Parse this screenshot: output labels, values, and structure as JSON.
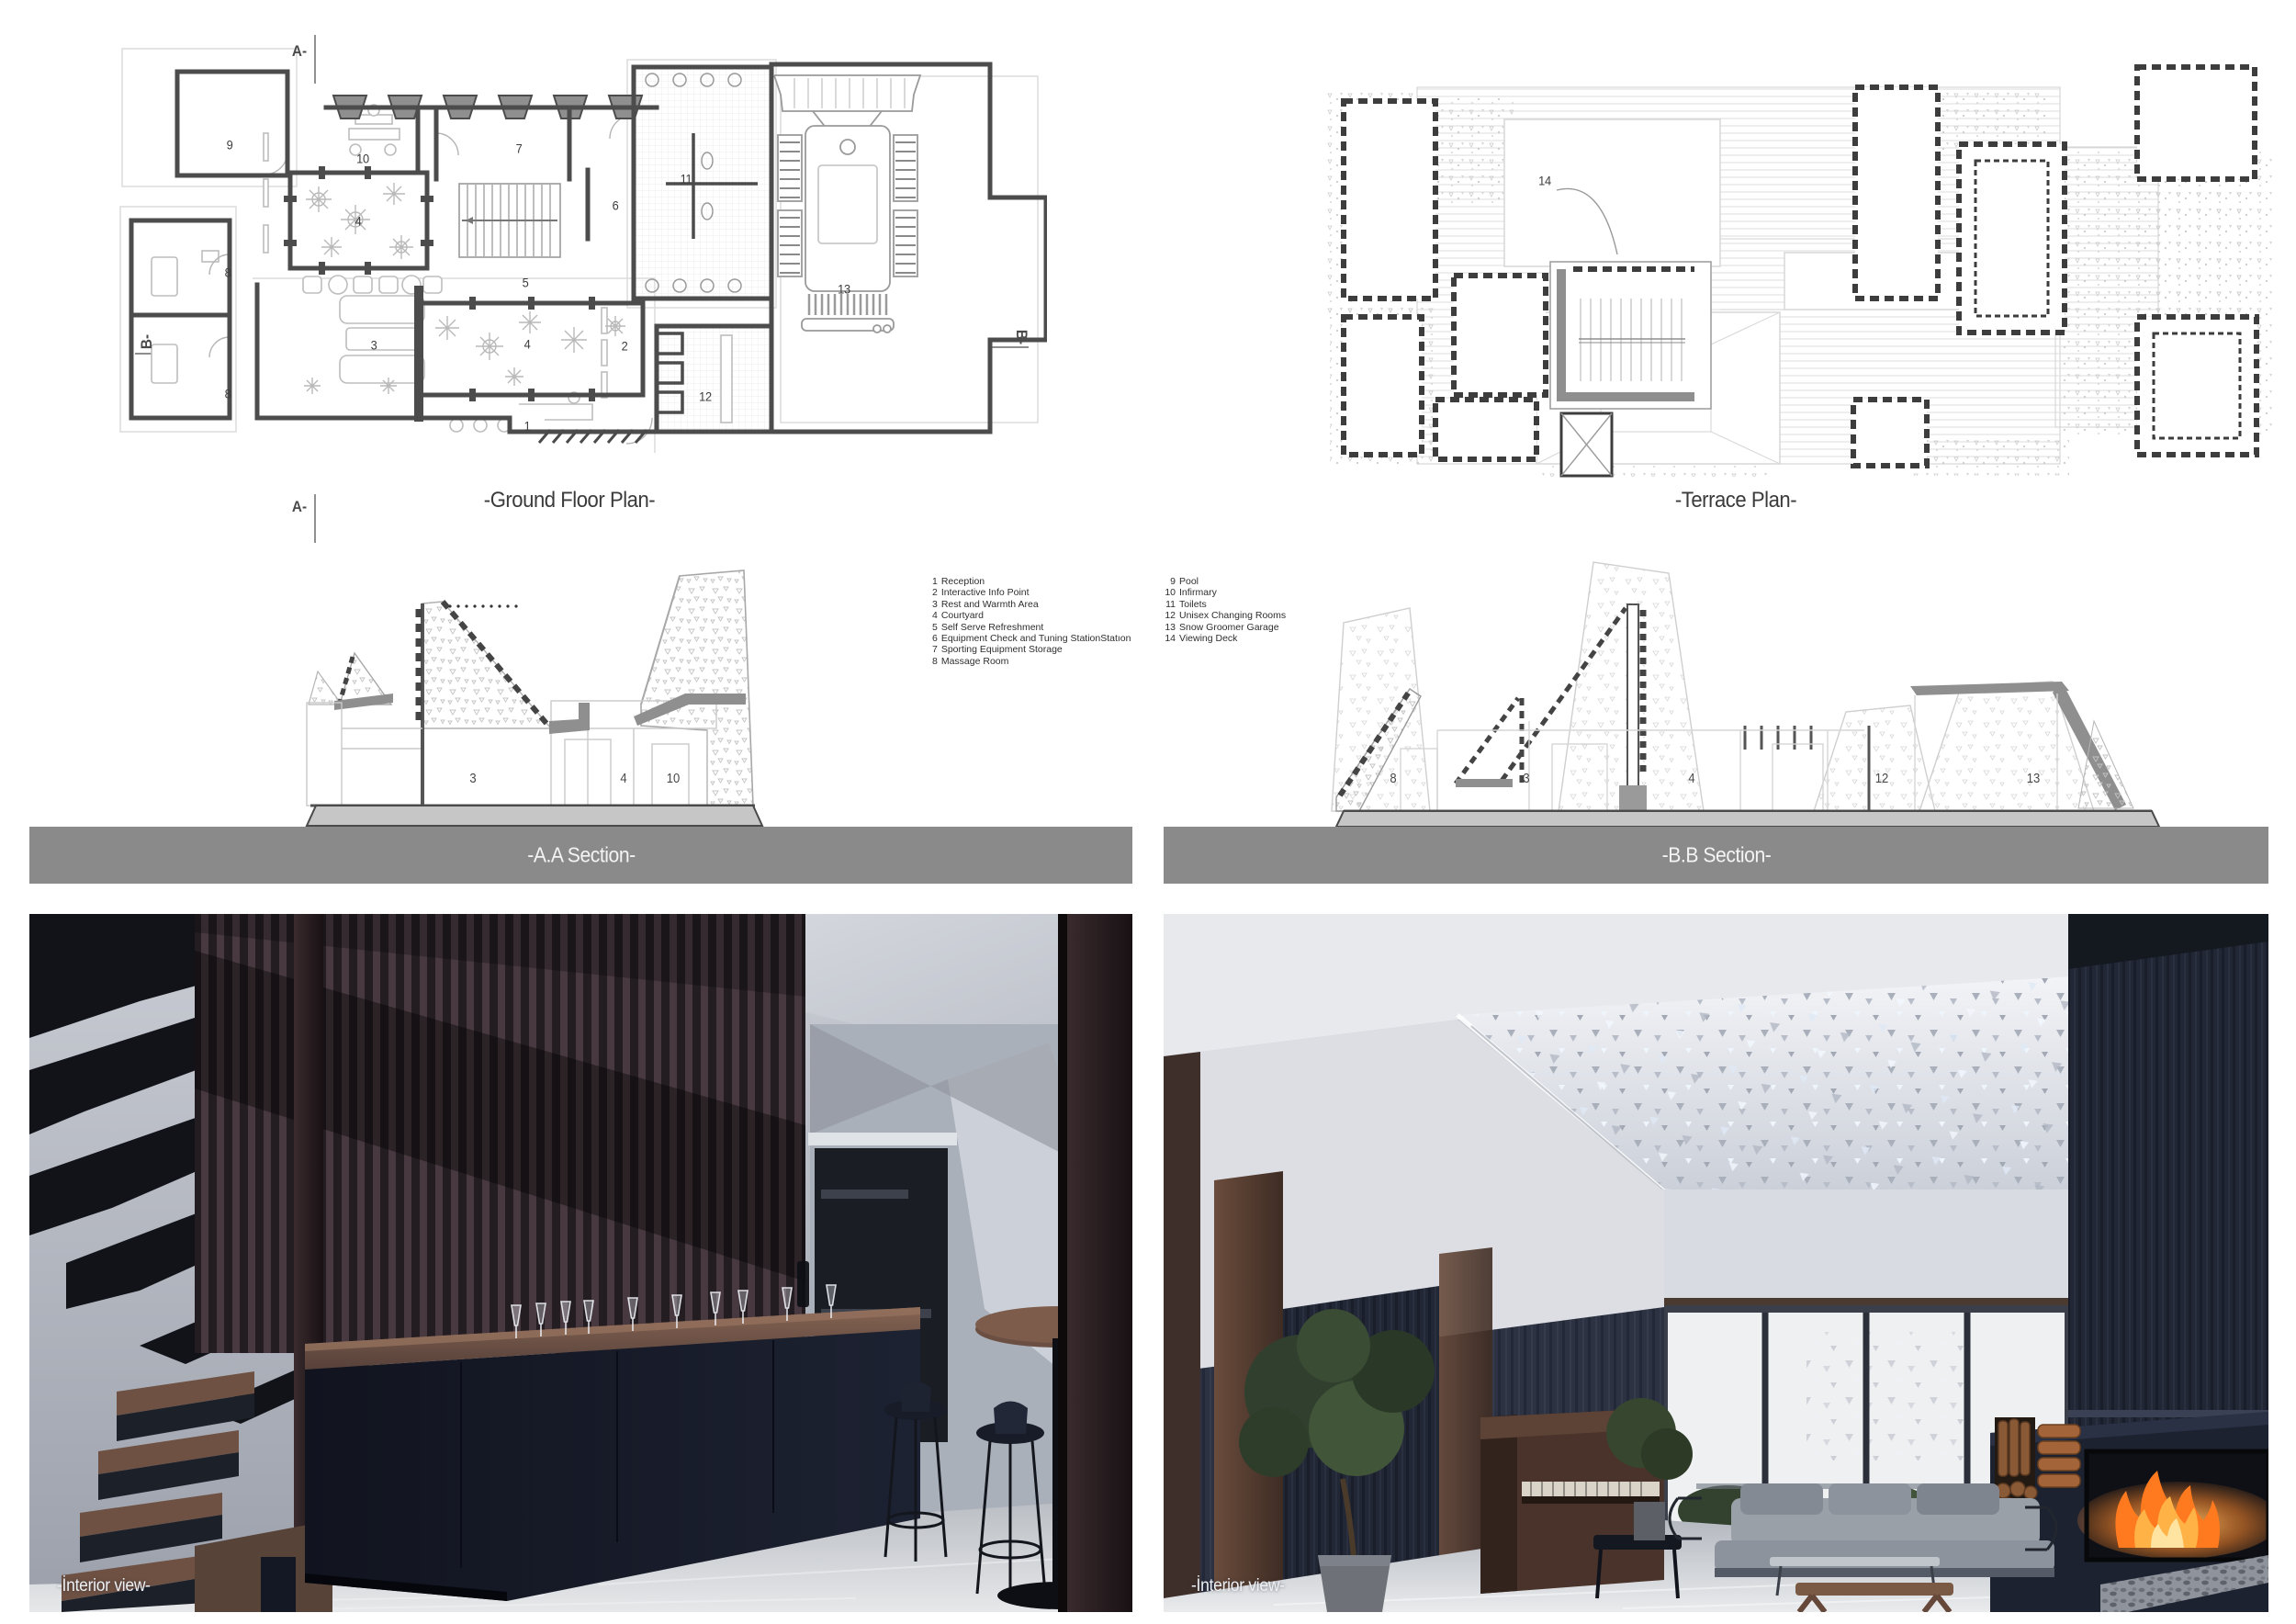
{
  "ground_floor": {
    "title": "-Ground Floor Plan-",
    "markers": {
      "a_top": "A-",
      "a_bottom": "A-",
      "b_left": "B-",
      "b_right": "B-"
    },
    "rooms": [
      "9",
      "10",
      "7",
      "6",
      "4",
      "5",
      "11",
      "8",
      "8",
      "3",
      "4",
      "1",
      "2",
      "12",
      "13"
    ]
  },
  "terrace": {
    "title": "-Terrace Plan-",
    "rooms": [
      "14"
    ]
  },
  "sections": {
    "aa": {
      "title": "-A.A Section-",
      "rooms": [
        "3",
        "4",
        "10"
      ]
    },
    "bb": {
      "title": "-B.B Section-",
      "rooms": [
        "8",
        "3",
        "4",
        "12",
        "13"
      ]
    }
  },
  "legend": {
    "left": [
      {
        "n": "1",
        "t": "Reception"
      },
      {
        "n": "2",
        "t": "Interactive Info Point"
      },
      {
        "n": "3",
        "t": "Rest and Warmth Area"
      },
      {
        "n": "4",
        "t": "Courtyard"
      },
      {
        "n": "5",
        "t": "Self Serve Refreshment"
      },
      {
        "n": "6",
        "t": "Equipment Check and Tuning StationStatıon"
      },
      {
        "n": "7",
        "t": "Sporting Equipment Storage"
      },
      {
        "n": "8",
        "t": "Massage Room"
      }
    ],
    "right": [
      {
        "n": "9",
        "t": "Pool"
      },
      {
        "n": "10",
        "t": "Infirmary"
      },
      {
        "n": "11",
        "t": "Toilets"
      },
      {
        "n": "12",
        "t": "Unisex Changing Rooms"
      },
      {
        "n": "13",
        "t": "Snow Groomer Garage"
      },
      {
        "n": "14",
        "t": "Viewing Deck"
      }
    ]
  },
  "interiors": {
    "left_label": "-İnterior view-",
    "right_label": "-İnterior view-"
  },
  "palette": {
    "wall_line": "#4c4c4c",
    "light_line": "#c9c9c9",
    "section_bar": "#8a8a8a",
    "ground_fill": "#c6c6c6",
    "navy": "#171b29",
    "wood": "#6b4f43",
    "fire_orange": "#ff8a2e"
  }
}
